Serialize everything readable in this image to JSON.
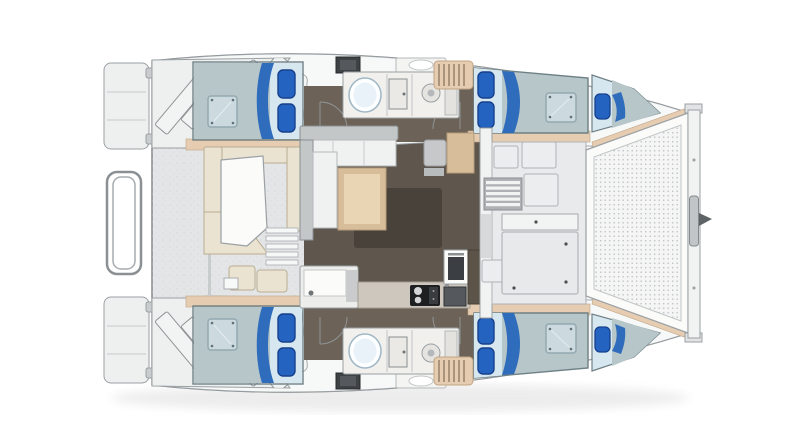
{
  "meta": {
    "type": "yacht floor plan",
    "subject": "sailing catamaran deck and accommodation layout, top-down view",
    "orientation": {
      "bow": "right",
      "stern": "left",
      "port_hull": "top",
      "starboard_hull": "bottom"
    }
  },
  "colors": {
    "bg": "#ffffff",
    "line": "#9aa0a3",
    "line_strong": "#7b8084",
    "deck": "#e4e5e6",
    "deck_light": "#eef0f0",
    "hull": "#f7f8f8",
    "trim": "#e6ccb1",
    "trim_dark": "#c0a584",
    "floor": "#5f574e",
    "floor_hull": "#6c6257",
    "floor_rug": "#48423b",
    "mattress": "#b7c6c9",
    "mattress_light": "#d7e7f0",
    "pillow": "#2563c1",
    "pillow_dark": "#16418c",
    "accent_curve": "#2f6cbb",
    "hatch_glass": "#cfdde2",
    "hatch_frame": "#8fa6ad",
    "cream": "#ebe3d1",
    "cream_edge": "#b9ad92",
    "white": "#fbfbfa",
    "wood": "#d8bd9b",
    "wood_light": "#e9d5b3",
    "counter": "#f1f0ed",
    "stove": "#1e1f21",
    "sink_dark": "#55585c",
    "mesh_base": "#f4f5f4",
    "mesh_dot": "#bfc5c5",
    "steel": "#c2c5c7"
  },
  "vessel": {
    "stern": {
      "swim_platforms": 2,
      "transom_step_flights": 2,
      "steps_per_flight": 4,
      "tender_rail": "U-shaped rail between transoms"
    },
    "cockpit": {
      "seating": "U-shaped upholstered bench",
      "table": "white cockpit table",
      "side_steps": 5,
      "aft_bench_modules": 2
    },
    "saloon": {
      "sofa": "L-shaped lounge seating",
      "saloon_table": "rectangular wood table",
      "nav_seat": 1,
      "nav_table": "wood chart table",
      "rug": "dark floor mat"
    },
    "galley": {
      "cooktop_burners": 2,
      "sink": 1,
      "oven": 1,
      "island_unit": "sink island with faucet"
    },
    "foredeck": {
      "hatch_panels": 5,
      "louvered_vent": 1,
      "access_wall": "bulkhead with sliding door from saloon"
    },
    "bow": {
      "trampoline": "mesh trampoline panel",
      "crossbeam": 1,
      "bowsprit_fitting": 1,
      "anchor_roller": 1
    },
    "hulls": [
      {
        "side": "port",
        "position": "top",
        "aft_cabin": {
          "berth": "double berth",
          "mattress_hatch": 1,
          "pillows": 2
        },
        "head": {
          "toilet": 1,
          "shower_compartment": 1,
          "shower_drain": 1,
          "washbasin": 1,
          "deck_hatch": 1
        },
        "companionway_steps": 1,
        "forward_cabin": {
          "berth": "double berth",
          "mattress_hatch": 1,
          "pillows": 2
        },
        "forepeak_berth": {
          "pillows": 1
        }
      },
      {
        "side": "starboard",
        "position": "bottom",
        "aft_cabin": {
          "berth": "double berth",
          "mattress_hatch": 1,
          "pillows": 2
        },
        "head": {
          "toilet": 1,
          "shower_compartment": 1,
          "shower_drain": 1,
          "washbasin": 1,
          "deck_hatch": 1
        },
        "companionway_steps": 1,
        "forward_cabin": {
          "berth": "double berth",
          "mattress_hatch": 1,
          "pillows": 2
        },
        "forepeak_berth": {
          "pillows": 1
        }
      }
    ]
  }
}
